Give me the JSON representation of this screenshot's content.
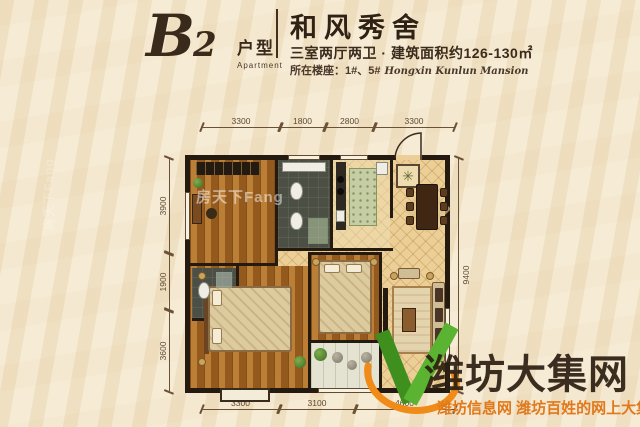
{
  "header": {
    "plan_code": "B",
    "plan_code_digit": "2",
    "plan_type_cn": "户型",
    "plan_type_en": "Apartment",
    "title": "和风秀舍",
    "specs": "三室两厅两卫 · 建筑面积约126-130㎡",
    "floor_label": "所在楼座：1#、5#",
    "floor_label_script": "Hongxin Kunlun Mansion"
  },
  "dimensions": {
    "top": [
      "3300",
      "1800",
      "2800",
      "3300"
    ],
    "bottom": [
      "3300",
      "3100",
      "4600"
    ],
    "left": [
      "3900",
      "1900",
      "3600"
    ],
    "right": [
      "9400"
    ]
  },
  "watermarks": {
    "fang": "房天下Fang",
    "site_name": "潍坊大集网",
    "site_tagline": "潍坊信息网 潍坊百姓的网上大集"
  },
  "icons": {
    "medallion": "✳"
  },
  "colors": {
    "background_cream": "#f4e7cd",
    "wall_dark": "#241a10",
    "text_brown": "#3a2a1b",
    "dimension_brown": "#5d4a33",
    "logo_green": "#5ab331",
    "logo_orange": "#ef8b16",
    "tagline_orange": "#e0791c",
    "watermark_dark": "#2c1f12"
  }
}
